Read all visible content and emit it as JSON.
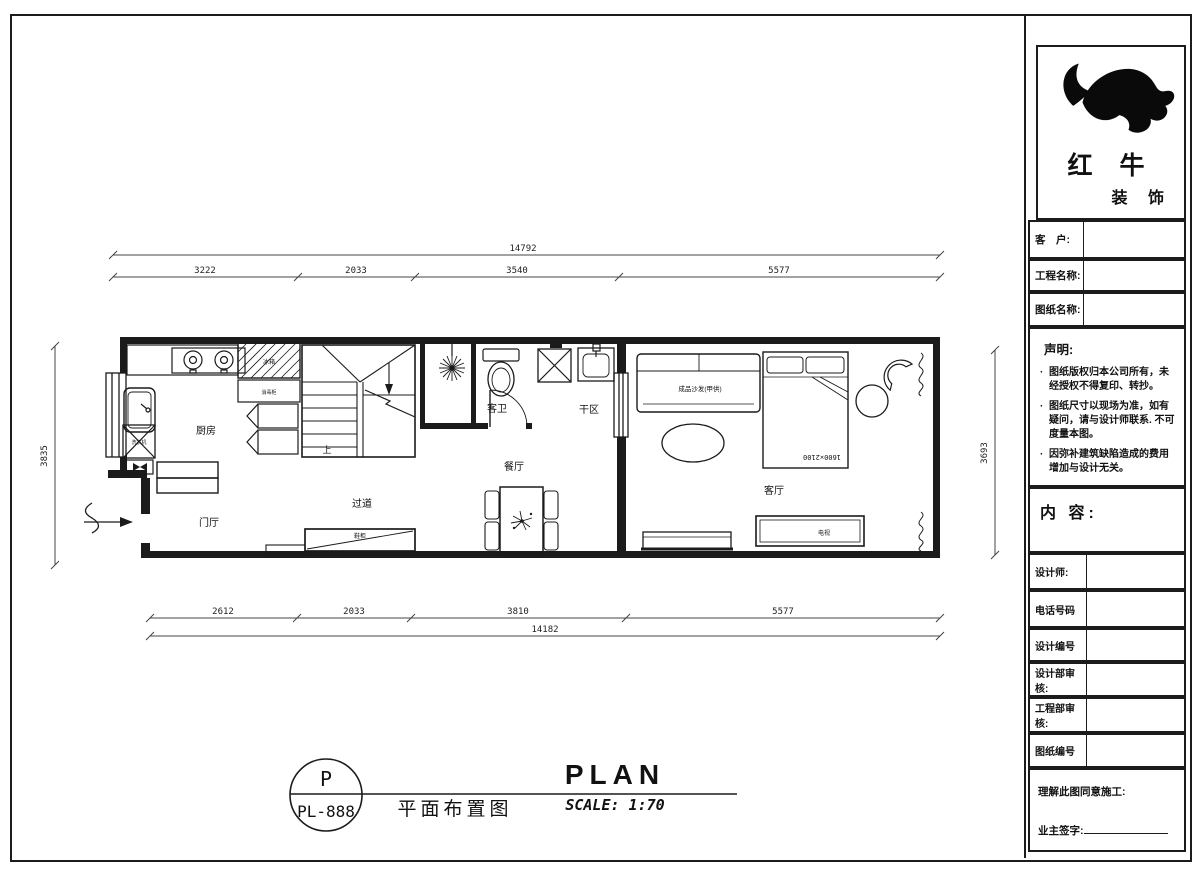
{
  "colors": {
    "line": "#1b1b1b",
    "bg": "#ffffff"
  },
  "plan": {
    "dims": {
      "top_total": "14792",
      "top_segments": [
        "3222",
        "2033",
        "3540",
        "5577"
      ],
      "bottom_segments": [
        "2612",
        "2033",
        "3810",
        "5577"
      ],
      "bottom_total": "14182",
      "left_height": "3835",
      "right_height": "3693"
    },
    "rooms": {
      "kitchen": "厨房",
      "foyer": "门厅",
      "corridor": "过道",
      "dining": "餐厅",
      "guest_bath": "客卫",
      "dry_area": "干区",
      "living": "客厅"
    },
    "furniture": {
      "sofa": "成品沙发(甲供)",
      "bed_size": "1600×2100",
      "stair_up": "上",
      "fridge": "冰箱",
      "sterilizer": "消毒柜",
      "washer": "洗衣机",
      "shoe_cabinet": "鞋柜",
      "tv": "电视"
    }
  },
  "title_bar": {
    "code_top": "P",
    "code_bottom": "PL-888",
    "name_cn": "平面布置图",
    "name_en": "PLAN",
    "scale": "SCALE: 1:70"
  },
  "title_block": {
    "brand": {
      "line1": "红 牛",
      "line2": "装 饰"
    },
    "fields": {
      "customer": "客　户:",
      "project": "工程名称:",
      "drawing": "图纸名称:"
    },
    "declaration": {
      "title": "声明:",
      "bullet": "·",
      "item1": "图纸版权归本公司所有，未经授权不得复印、转抄。",
      "item2": "图纸尺寸以现场为准，如有疑问，请与设计师联系. 不可度量本图。",
      "item3": "因弥补建筑缺陷造成的费用增加与设计无关。"
    },
    "content_label": "内 容:",
    "rows": {
      "designer": "设计师:",
      "phone": "电话号码",
      "design_no": "设计编号",
      "design_review": "设计部审核:",
      "eng_review": "工程部审核:",
      "drawing_no": "图纸编号"
    },
    "signature": {
      "agree": "理解此图同意施工:",
      "owner": "业主签字:"
    }
  }
}
